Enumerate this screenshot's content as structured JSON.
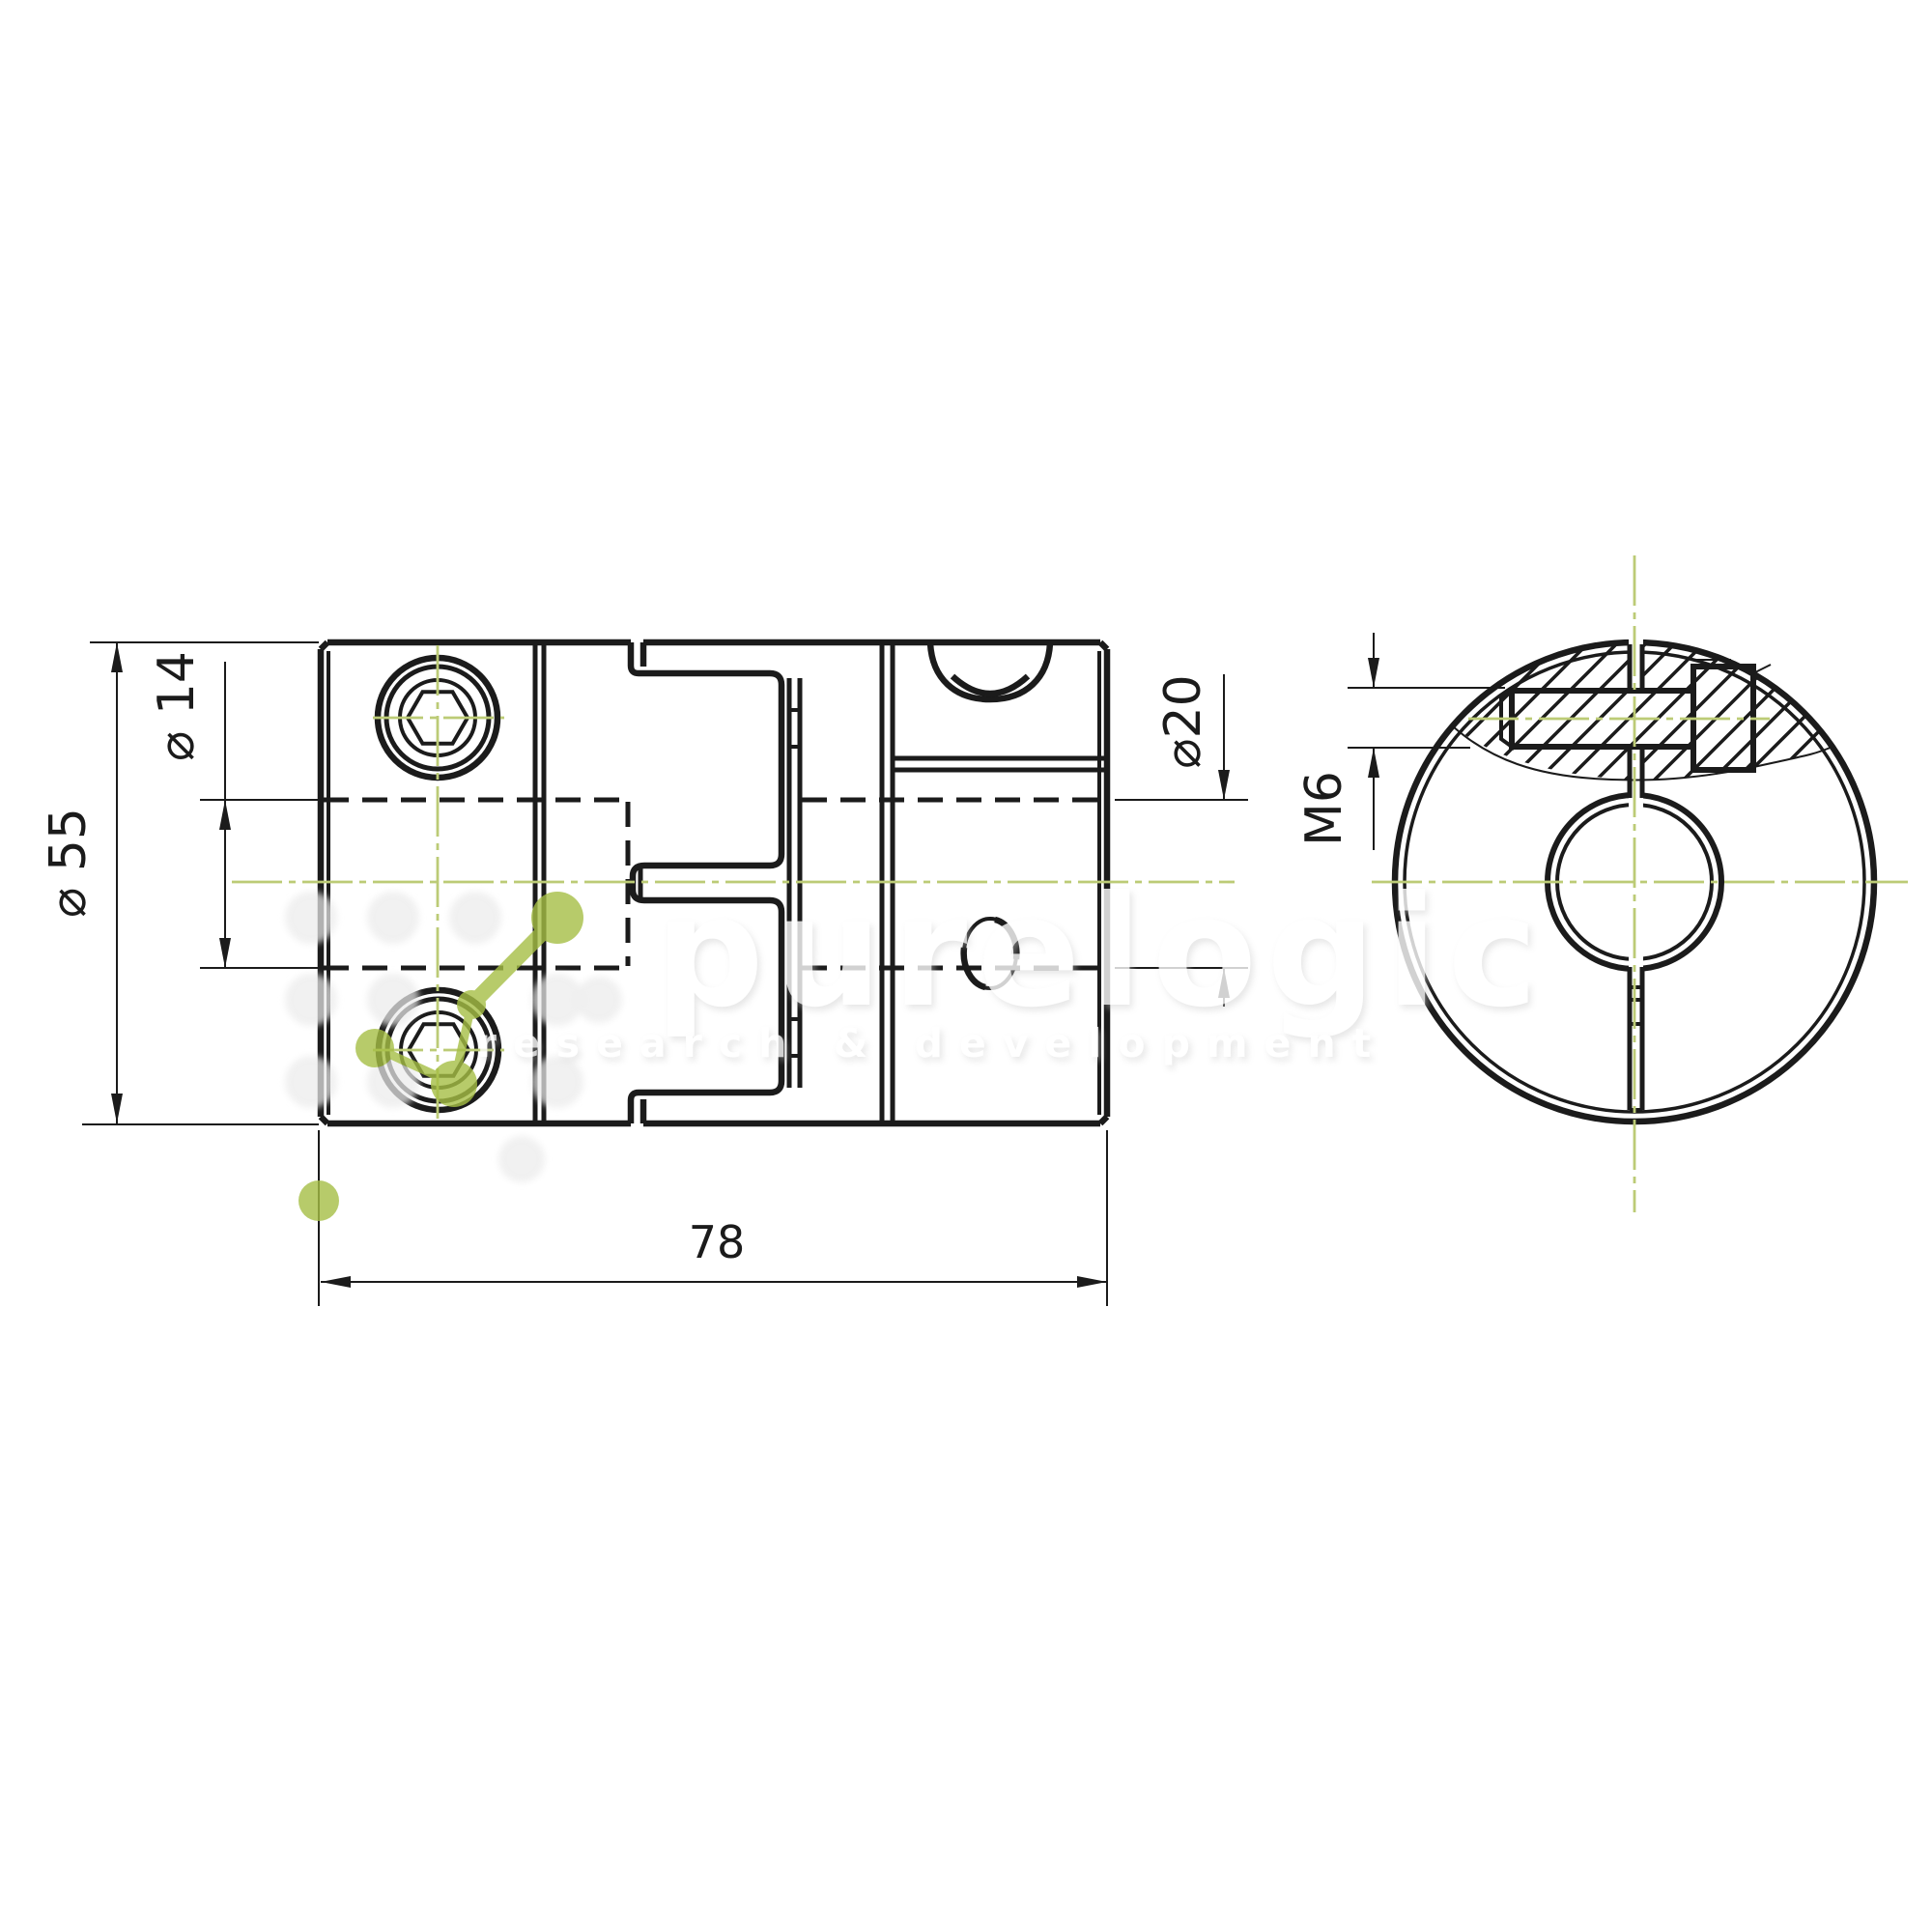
{
  "drawing": {
    "dimensions": {
      "outer_diameter": "⌀ 55",
      "left_bore_diameter": "⌀ 14",
      "right_bore_diameter": "⌀20",
      "set_screw_thread": "M6",
      "overall_length": "78"
    },
    "watermark": {
      "brand": "purelogic",
      "tagline": "research & development"
    },
    "colors": {
      "line": "#1b1b1b",
      "centerline": "#bccb76",
      "accent_green": "#a6bf45",
      "background": "#ffffff",
      "watermark_gray": "#c9c9c9"
    }
  }
}
